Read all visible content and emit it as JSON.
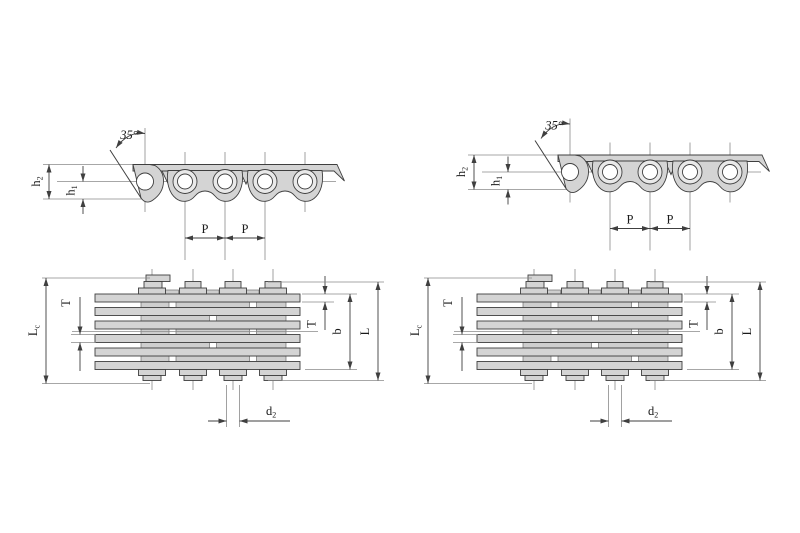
{
  "page": {
    "background": "#ffffff"
  },
  "colors": {
    "line": "#3f3f3f",
    "thin_line": "#8a8a8a",
    "plate_fill": "#d4d4d4",
    "ring_fill": "#e9e9e9",
    "hole_fill": "#ffffff",
    "text": "#1a1a1a"
  },
  "side_view": {
    "angle_label": "35°",
    "height_outer": {
      "base": "h",
      "sub": "2"
    },
    "height_inner": {
      "base": "h",
      "sub": "1"
    },
    "pitch_label_1": "P",
    "pitch_label_2": "P"
  },
  "plan_view": {
    "length_over_pins": {
      "base": "L",
      "sub": "c"
    },
    "plate_thickness_left": "T",
    "plate_thickness_right": "T",
    "inner_width": "b",
    "length_over_rivets": "L",
    "pin_diameter": {
      "base": "d",
      "sub": "2"
    }
  }
}
